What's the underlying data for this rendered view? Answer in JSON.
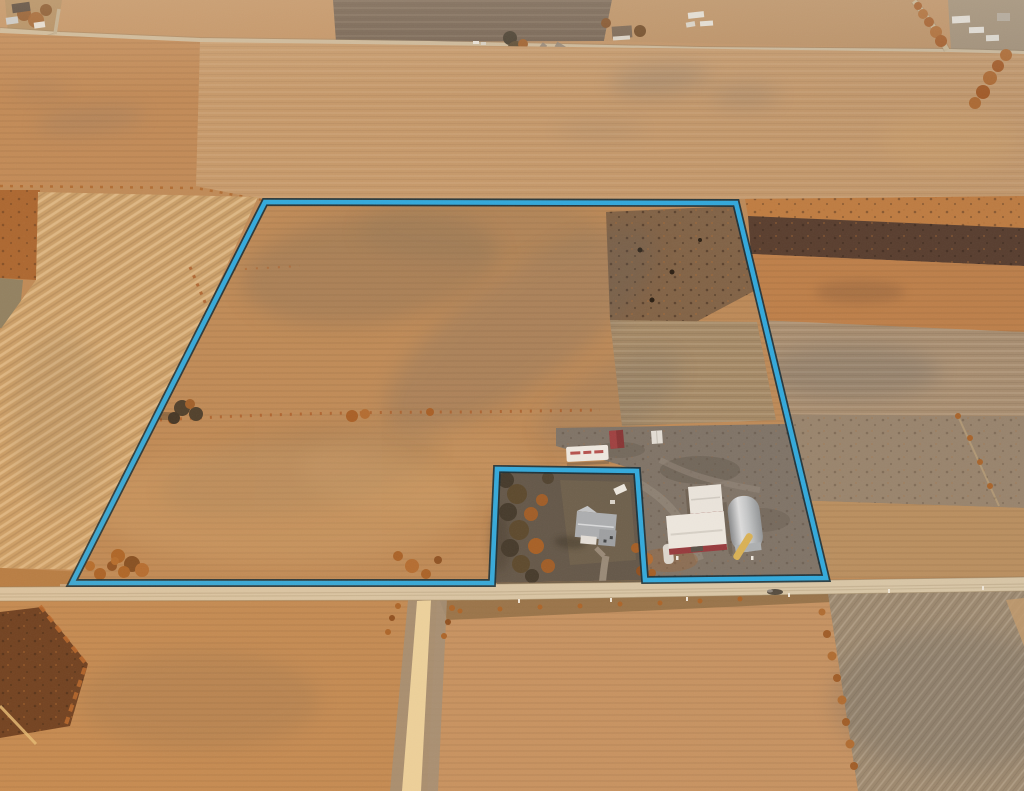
{
  "scene": {
    "type": "aerial-drone-photograph",
    "subject": "flat farmland at golden hour with one large parcel outlined in blue",
    "lighting": "low warm sun, long shadows, haze toward the horizon at top",
    "text_visible": "none"
  },
  "parcel": {
    "outline_points": "265,202 736,203 826,578 645,580 637,471 497,469 492,583 72,583",
    "line_color": "#2BAAE2",
    "casing_color": "#0D2836",
    "shape": "large quadrilateral tract with a rectangular farmhouse lot notched out of the south boundary"
  },
  "colors": {
    "field_tan": "#BE8A55",
    "field_orange": "#C07F45",
    "field_pale_striped": "#C9A06B",
    "field_gray": "#A78D70",
    "plowed_dark": "#6E5E50",
    "stubble_dark": "#553A2B",
    "county_road": "#D8C8AA",
    "gravel_road": "#ECD5A2",
    "farmyard_gray": "#7B7268",
    "yard_dark": "#5D5449",
    "tree_dark": "#3E382C",
    "brush_orange": "#A85E26",
    "house_roof_gray": "#A9AFB5",
    "barn_red": "#8E3136",
    "shed_white": "#EDEAE4",
    "quonset_gray": "#B9BEC3",
    "auger_yellow": "#D9B255"
  },
  "features": {
    "roads": [
      "paved county road running across the bottom of the frame",
      "light gravel road running south from the county road",
      "township road across the top of the frame",
      "branch road to the lower left at top",
      "diagonal road at the top right lined with brush"
    ],
    "buildings": [
      "white farmhouse with gray roof inside the excluded lot",
      "red-and-white gabled barn",
      "large white machine shed with red trim",
      "gray steel quonset shed",
      "white grain trailer with red lettering",
      "small red shed",
      "small white shed",
      "farmstead with windbreak trees on the top road",
      "white sheds and houses along the top road"
    ],
    "vegetation": [
      "windbreak trees and orange shrubs around the farmhouse lot",
      "rows of orange brush along field edges",
      "scattered orange bushes along the parcel boundary and roads"
    ],
    "vehicles": [
      "white pickup parked near the farmhouse",
      "dark vehicle on the county road"
    ]
  }
}
